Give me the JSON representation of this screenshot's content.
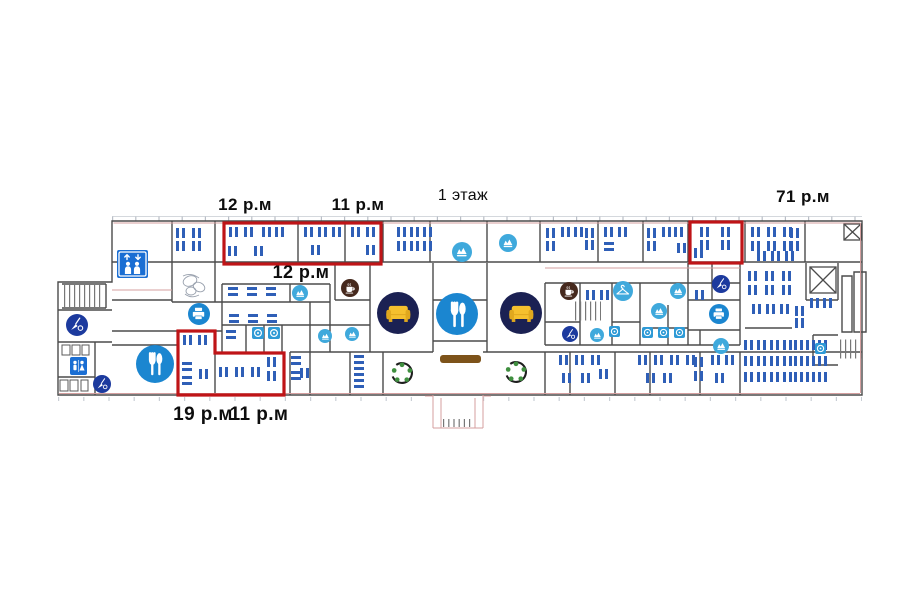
{
  "title": {
    "text": "1 этаж"
  },
  "labels": [
    {
      "text": "12 р.м",
      "x": 245,
      "y": 196,
      "size": 17,
      "bold": true
    },
    {
      "text": "11 р.м",
      "x": 358,
      "y": 196,
      "size": 17,
      "bold": true
    },
    {
      "text": "71 р.м",
      "x": 803,
      "y": 188,
      "size": 17,
      "bold": true
    },
    {
      "text": "12 р.м",
      "x": 301,
      "y": 263,
      "size": 18,
      "bold": true
    },
    {
      "text": "19 р.м",
      "x": 203,
      "y": 405,
      "size": 19,
      "bold": true
    },
    {
      "text": "11 р.м",
      "x": 259,
      "y": 405,
      "size": 19,
      "bold": true
    }
  ],
  "colors": {
    "wall": "#4b4b4b",
    "wall_accent": "#d49f9f",
    "desk": "#2f5fb7",
    "highlight": "#bf1417",
    "icon_blue": "#1b86d0",
    "icon_lightblue": "#3fa9dc",
    "icon_navy": "#1c3a9e",
    "icon_darknavy": "#1b2153",
    "coffee_brown": "#46291d",
    "sofa_yellow": "#f5c02e",
    "sofa_yellow_dark": "#e0a81e",
    "table_green": "#3f8f3f",
    "counter_brown": "#7d531a",
    "sign_blue": "#1a6ed3",
    "fixture_blue": "#2e9ad6",
    "text": "#0d0d0d"
  },
  "highlights": [
    {
      "shape": "rect",
      "x": 224,
      "y": 223,
      "w": 157,
      "h": 41
    },
    {
      "shape": "rect",
      "x": 690,
      "y": 222,
      "w": 52,
      "h": 41
    },
    {
      "shape": "polygon",
      "points": "178,331 215,331 215,353 284,353 284,395 178,395"
    }
  ],
  "icons": [
    {
      "name": "elevator-sign",
      "type": "elevator",
      "x": 117,
      "y": 250,
      "w": 31,
      "h": 28
    },
    {
      "name": "wc-sign",
      "type": "wc",
      "x": 70,
      "y": 357,
      "w": 17,
      "h": 18
    },
    {
      "name": "printer-icon",
      "type": "printer",
      "cx": 199,
      "cy": 314,
      "r": 11
    },
    {
      "name": "printer-icon",
      "type": "printer",
      "cx": 719,
      "cy": 314,
      "r": 10
    },
    {
      "name": "dining-icon",
      "type": "dining",
      "cx": 155,
      "cy": 364,
      "r": 19
    },
    {
      "name": "dining-icon",
      "type": "dining",
      "cx": 457,
      "cy": 314,
      "r": 21
    },
    {
      "name": "sofa-lounge-icon",
      "type": "sofa",
      "cx": 398,
      "cy": 313,
      "r": 21
    },
    {
      "name": "sofa-lounge-icon",
      "type": "sofa",
      "cx": 521,
      "cy": 313,
      "r": 21
    },
    {
      "name": "coffee-icon",
      "type": "coffee",
      "cx": 350,
      "cy": 288,
      "r": 9
    },
    {
      "name": "coffee-icon",
      "type": "coffee",
      "cx": 569,
      "cy": 291,
      "r": 9
    },
    {
      "name": "wardrobe-hanger-icon",
      "type": "hanger",
      "cx": 623,
      "cy": 291,
      "r": 10
    },
    {
      "name": "meeting-icon",
      "type": "meeting",
      "cx": 300,
      "cy": 293,
      "r": 8
    },
    {
      "name": "meeting-icon",
      "type": "meeting",
      "cx": 462,
      "cy": 252,
      "r": 10
    },
    {
      "name": "meeting-icon",
      "type": "meeting",
      "cx": 508,
      "cy": 243,
      "r": 9
    },
    {
      "name": "meeting-icon",
      "type": "meeting",
      "cx": 678,
      "cy": 291,
      "r": 8
    },
    {
      "name": "meeting-icon",
      "type": "meeting",
      "cx": 659,
      "cy": 311,
      "r": 8
    },
    {
      "name": "meeting-icon",
      "type": "meeting",
      "cx": 597,
      "cy": 335,
      "r": 7
    },
    {
      "name": "meeting-icon",
      "type": "meeting",
      "cx": 325,
      "cy": 336,
      "r": 7
    },
    {
      "name": "meeting-icon",
      "type": "meeting",
      "cx": 352,
      "cy": 334,
      "r": 7
    },
    {
      "name": "meeting-icon",
      "type": "meeting",
      "cx": 721,
      "cy": 346,
      "r": 8
    },
    {
      "name": "cleaning-icon",
      "type": "clean",
      "cx": 570,
      "cy": 334,
      "r": 8
    },
    {
      "name": "cleaning-icon",
      "type": "clean",
      "cx": 721,
      "cy": 284,
      "r": 9
    },
    {
      "name": "cleaning-icon",
      "type": "clean",
      "cx": 77,
      "cy": 325,
      "r": 11
    },
    {
      "name": "cleaning-icon",
      "type": "clean",
      "cx": 102,
      "cy": 384,
      "r": 9
    },
    {
      "name": "round-table",
      "type": "table",
      "cx": 402,
      "cy": 373,
      "r": 14
    },
    {
      "name": "round-table",
      "type": "table",
      "cx": 516,
      "cy": 372,
      "r": 14
    },
    {
      "name": "fixture-icon",
      "type": "fixture",
      "x": 252,
      "y": 327,
      "w": 12,
      "h": 12
    },
    {
      "name": "fixture-icon",
      "type": "fixture",
      "x": 268,
      "y": 327,
      "w": 12,
      "h": 12
    },
    {
      "name": "fixture-icon",
      "type": "fixture",
      "x": 609,
      "y": 326,
      "w": 11,
      "h": 11
    },
    {
      "name": "fixture-icon",
      "type": "fixture",
      "x": 642,
      "y": 327,
      "w": 11,
      "h": 11
    },
    {
      "name": "fixture-icon",
      "type": "fixture",
      "x": 658,
      "y": 327,
      "w": 11,
      "h": 11
    },
    {
      "name": "fixture-icon",
      "type": "fixture",
      "x": 674,
      "y": 327,
      "w": 11,
      "h": 11
    },
    {
      "name": "fixture-icon",
      "type": "fixture",
      "x": 815,
      "y": 343,
      "w": 11,
      "h": 11
    },
    {
      "name": "reception-desk",
      "type": "counter",
      "x": 440,
      "y": 355,
      "w": 41,
      "h": 8
    }
  ],
  "desk_clusters": [
    {
      "x": 176,
      "y": 228,
      "cols": 2,
      "rows": 2,
      "dx": 16,
      "dy": 13,
      "o": "v"
    },
    {
      "x": 229,
      "y": 227,
      "cols": 2,
      "rows": 1,
      "dx": 15,
      "o": "v"
    },
    {
      "x": 228,
      "y": 246,
      "cols": 2,
      "rows": 1,
      "dx": 26,
      "o": "v"
    },
    {
      "x": 262,
      "y": 227,
      "cols": 2,
      "rows": 1,
      "dx": 13,
      "o": "v"
    },
    {
      "x": 304,
      "y": 227,
      "cols": 3,
      "rows": 1,
      "dx": 14,
      "o": "v"
    },
    {
      "x": 311,
      "y": 245,
      "cols": 1,
      "rows": 1,
      "o": "v"
    },
    {
      "x": 351,
      "y": 227,
      "cols": 2,
      "rows": 1,
      "dx": 15,
      "o": "v"
    },
    {
      "x": 366,
      "y": 245,
      "cols": 1,
      "rows": 1,
      "o": "v"
    },
    {
      "x": 397,
      "y": 227,
      "cols": 3,
      "rows": 2,
      "dx": 13,
      "dy": 14,
      "o": "v"
    },
    {
      "x": 546,
      "y": 228,
      "cols": 1,
      "rows": 2,
      "dy": 13,
      "o": "v"
    },
    {
      "x": 561,
      "y": 227,
      "cols": 2,
      "rows": 1,
      "dx": 13,
      "o": "v"
    },
    {
      "x": 585,
      "y": 228,
      "cols": 1,
      "rows": 2,
      "dy": 12,
      "o": "v"
    },
    {
      "x": 604,
      "y": 227,
      "cols": 2,
      "rows": 1,
      "dx": 14,
      "o": "v"
    },
    {
      "x": 604,
      "y": 242,
      "cols": 1,
      "rows": 1,
      "o": "h"
    },
    {
      "x": 647,
      "y": 228,
      "cols": 1,
      "rows": 2,
      "dy": 13,
      "o": "v"
    },
    {
      "x": 662,
      "y": 227,
      "cols": 2,
      "rows": 1,
      "dx": 12,
      "o": "v"
    },
    {
      "x": 677,
      "y": 243,
      "cols": 1,
      "rows": 1,
      "o": "v"
    },
    {
      "x": 700,
      "y": 227,
      "cols": 2,
      "rows": 2,
      "dx": 21,
      "dy": 13,
      "o": "v"
    },
    {
      "x": 694,
      "y": 248,
      "cols": 1,
      "rows": 1,
      "o": "v"
    },
    {
      "x": 751,
      "y": 227,
      "cols": 3,
      "rows": 2,
      "dx": 16,
      "dy": 14,
      "o": "v"
    },
    {
      "x": 790,
      "y": 228,
      "cols": 1,
      "rows": 2,
      "dy": 13,
      "o": "v"
    },
    {
      "x": 757,
      "y": 251,
      "cols": 3,
      "rows": 1,
      "dx": 14,
      "o": "v"
    },
    {
      "x": 748,
      "y": 271,
      "cols": 3,
      "rows": 2,
      "dx": 17,
      "dy": 14,
      "o": "v"
    },
    {
      "x": 810,
      "y": 298,
      "cols": 2,
      "rows": 1,
      "dx": 13,
      "o": "v"
    },
    {
      "x": 752,
      "y": 304,
      "cols": 3,
      "rows": 1,
      "dx": 14,
      "o": "v"
    },
    {
      "x": 795,
      "y": 306,
      "cols": 1,
      "rows": 2,
      "dy": 12,
      "o": "v"
    },
    {
      "x": 744,
      "y": 340,
      "cols": 4,
      "rows": 3,
      "dx": 13,
      "dy": 16,
      "o": "v"
    },
    {
      "x": 794,
      "y": 340,
      "cols": 3,
      "rows": 3,
      "dx": 12,
      "dy": 16,
      "o": "v"
    },
    {
      "x": 228,
      "y": 287,
      "cols": 3,
      "rows": 1,
      "dx": 19,
      "o": "h"
    },
    {
      "x": 229,
      "y": 314,
      "cols": 3,
      "rows": 1,
      "dx": 19,
      "o": "h"
    },
    {
      "x": 226,
      "y": 330,
      "cols": 1,
      "rows": 1,
      "o": "h"
    },
    {
      "x": 586,
      "y": 290,
      "cols": 2,
      "rows": 1,
      "dx": 14,
      "o": "v"
    },
    {
      "x": 695,
      "y": 290,
      "cols": 1,
      "rows": 1,
      "o": "v"
    },
    {
      "x": 183,
      "y": 335,
      "cols": 2,
      "rows": 1,
      "dx": 15,
      "o": "v"
    },
    {
      "x": 182,
      "y": 362,
      "cols": 1,
      "rows": 2,
      "dy": 14,
      "o": "h"
    },
    {
      "x": 199,
      "y": 369,
      "cols": 1,
      "rows": 1,
      "o": "v"
    },
    {
      "x": 219,
      "y": 367,
      "cols": 3,
      "rows": 1,
      "dx": 16,
      "o": "v"
    },
    {
      "x": 267,
      "y": 357,
      "cols": 1,
      "rows": 2,
      "dy": 14,
      "o": "v"
    },
    {
      "x": 291,
      "y": 356,
      "cols": 1,
      "rows": 2,
      "dy": 15,
      "o": "h"
    },
    {
      "x": 300,
      "y": 368,
      "cols": 1,
      "rows": 1,
      "o": "v"
    },
    {
      "x": 354,
      "y": 355,
      "cols": 1,
      "rows": 3,
      "dy": 12,
      "o": "h"
    },
    {
      "x": 559,
      "y": 355,
      "cols": 3,
      "rows": 1,
      "dx": 16,
      "o": "v"
    },
    {
      "x": 562,
      "y": 373,
      "cols": 2,
      "rows": 1,
      "dx": 19,
      "o": "v"
    },
    {
      "x": 599,
      "y": 369,
      "cols": 1,
      "rows": 1,
      "o": "v"
    },
    {
      "x": 638,
      "y": 355,
      "cols": 4,
      "rows": 1,
      "dx": 16,
      "o": "v"
    },
    {
      "x": 646,
      "y": 373,
      "cols": 2,
      "rows": 1,
      "dx": 17,
      "o": "v"
    },
    {
      "x": 694,
      "y": 357,
      "cols": 1,
      "rows": 2,
      "dy": 14,
      "o": "v"
    },
    {
      "x": 711,
      "y": 355,
      "cols": 2,
      "rows": 1,
      "dx": 14,
      "o": "v"
    },
    {
      "x": 715,
      "y": 373,
      "cols": 1,
      "rows": 1,
      "o": "v"
    }
  ]
}
